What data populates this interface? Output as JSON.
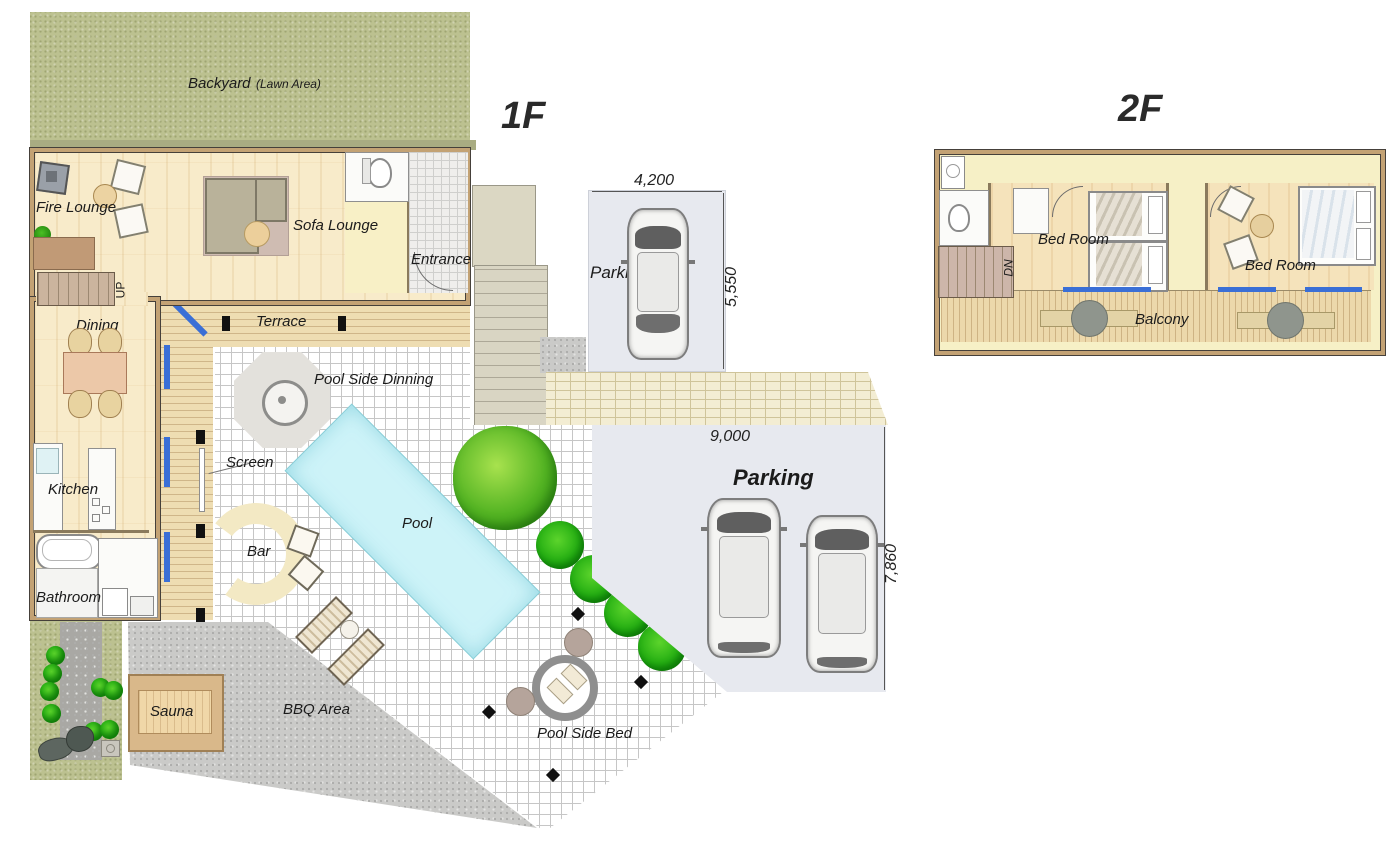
{
  "floor1": {
    "title": "1F",
    "backyard": {
      "label": "Backyard",
      "sublabel": "(Lawn Area)"
    },
    "rooms": {
      "fire_lounge": "Fire Lounge",
      "sofa_lounge": "Sofa Lounge",
      "entrance": "Entrance",
      "dining": "Dining",
      "terrace": "Terrace",
      "pool_side_dining": "Pool Side Dinning",
      "screen": "Screen",
      "kitchen": "Kitchen",
      "pool": "Pool",
      "bar": "Bar",
      "bathroom": "Bathroom",
      "sauna": "Sauna",
      "bbq_area": "BBQ Area",
      "pool_side_bed": "Pool Side Bed",
      "stairs_up": "UP"
    },
    "parking_single": {
      "label": "Parking",
      "width_dim": "4,200",
      "depth_dim": "5,550"
    },
    "parking_double": {
      "label": "Parking",
      "width_dim": "9,000",
      "depth_dim": "7,860"
    }
  },
  "floor2": {
    "title": "2F",
    "rooms": {
      "bedroom_left": "Bed Room",
      "bedroom_right": "Bed Room",
      "balcony": "Balcony",
      "stairs_down": "DN"
    }
  },
  "colors": {
    "lawn_green": "#bcc190",
    "wood_floor": "#f8ebca",
    "deck_wood": "#eeddb2",
    "pool_water": "#cdf3f8",
    "parking_gray": "#e7e9ef",
    "gravel_gray": "#cacac8",
    "brick_beige": "#f3edd3",
    "window_blue": "#3a6fd6",
    "tree_green": "#2e9210"
  }
}
